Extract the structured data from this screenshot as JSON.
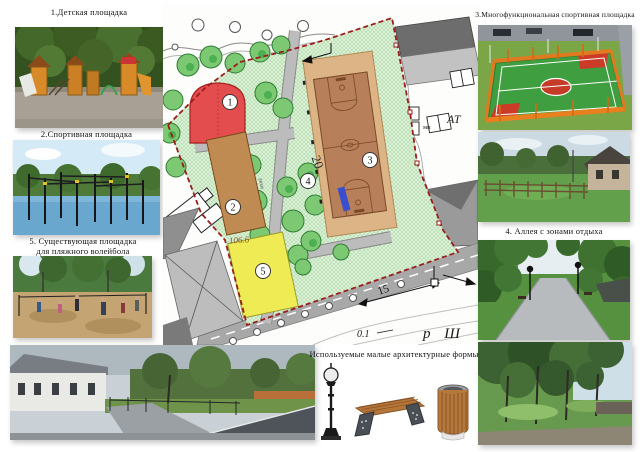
{
  "captions": {
    "playground": "1.Детская площадка",
    "sports": "2.Спортивная площадка",
    "multifunctional": "3.Многофункциональная спортивная площадка",
    "alley": "4. Аллея с зонами отдыха",
    "volleyball_line1": "5. Существующая площадка",
    "volleyball_line2": "для пляжного волейбола",
    "maf": "Используемые малые архитектурные формы"
  },
  "plan": {
    "labels": {
      "z1": "1",
      "z2": "2",
      "z3": "3",
      "z4": "4",
      "z5": "5"
    },
    "annotations": {
      "elevation": "106.6",
      "road_width": "20",
      "distance": "15",
      "slope": "0.1",
      "street": "р Ш",
      "cadastral_small": "мн",
      "cadastral_large": "АТ",
      "zone2_length": "24000"
    },
    "colors": {
      "boundary": "#9b1c1c",
      "greenery": "#ddf0d8",
      "tree": "#7cc873",
      "zone1_playground": "#e44d4d",
      "zone2_sport": "#c08b52",
      "zone3_court": "#b77f5a",
      "zone5_volleyball": "#eeeb55",
      "path_gray": "#b3b3b3",
      "accent_blue": "#3a4fd0"
    }
  }
}
